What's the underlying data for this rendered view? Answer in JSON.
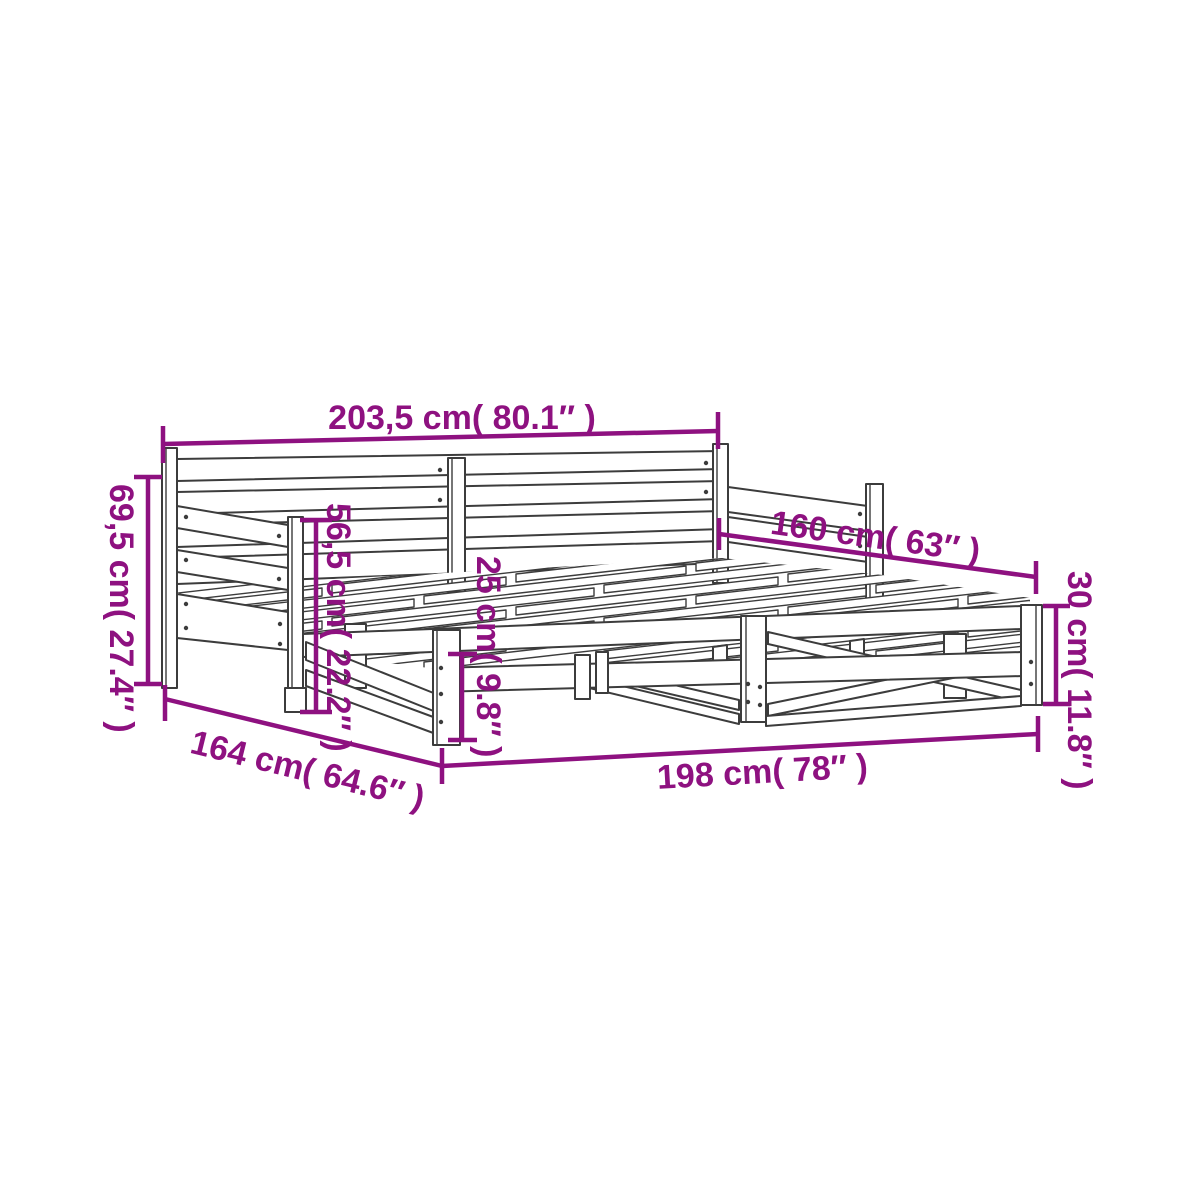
{
  "diagram": {
    "subject": "daybed-with-pullout-trundle-dimension-diagram",
    "style": {
      "line_color": "#3c3c3c",
      "dimension_color": "#8e1180",
      "background": "#ffffff"
    },
    "dimensions": {
      "total_length": "203,5 cm( 80.1″ )",
      "back_height": "69,5 cm( 27.4″ )",
      "armrest_height": "56,5 cm( 22.2″ )",
      "base_frame_height": "25 cm( 9.8″ )",
      "extended_width": "160 cm( 63″ )",
      "trundle_height": "30 cm( 11.8″ )",
      "floor_depth": "164 cm( 64.6″ )",
      "front_length": "198 cm( 78″ )"
    }
  }
}
